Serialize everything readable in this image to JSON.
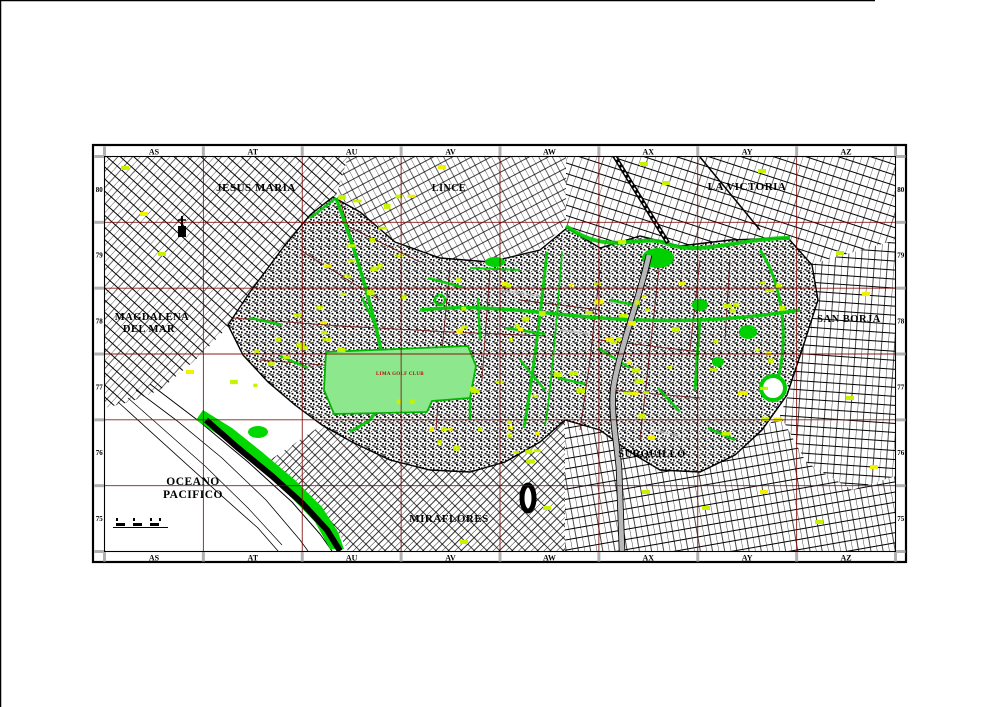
{
  "frame": {
    "columns": [
      "AS",
      "AT",
      "AU",
      "AV",
      "AW",
      "AX",
      "AY",
      "AZ"
    ],
    "rows": [
      "80",
      "79",
      "78",
      "77",
      "76",
      "75"
    ]
  },
  "labels": {
    "districts": [
      {
        "id": "jesus-maria",
        "text": "JESUS MARIA",
        "x": 256,
        "y": 191,
        "size": 11
      },
      {
        "id": "lince",
        "text": "LINCE",
        "x": 449,
        "y": 191,
        "size": 10
      },
      {
        "id": "la-victoria",
        "text": "LA VICTORIA",
        "x": 747,
        "y": 190,
        "size": 11
      },
      {
        "id": "magdalena-line1",
        "text": "MAGDALENA",
        "x": 152,
        "y": 320,
        "size": 10.5
      },
      {
        "id": "magdalena-line2",
        "text": "DEL MAR",
        "x": 149,
        "y": 332,
        "size": 10.5
      },
      {
        "id": "san-borja",
        "text": "SAN BORJA",
        "x": 849,
        "y": 322,
        "size": 10.5
      },
      {
        "id": "surquillo",
        "text": "SURQUILLO",
        "x": 652,
        "y": 457,
        "size": 10.5
      },
      {
        "id": "miraflores",
        "text": "MIRAFLORES",
        "x": 449,
        "y": 522,
        "size": 11
      },
      {
        "id": "oceano-line1",
        "text": "OCEANO",
        "x": 193,
        "y": 485,
        "size": 11.5
      },
      {
        "id": "oceano-line2",
        "text": "PACIFICO",
        "x": 193,
        "y": 498,
        "size": 11.5
      }
    ],
    "park": {
      "id": "lima-golf-club",
      "text": "LIMA GOLF CLUB",
      "x": 400,
      "y": 375,
      "size": 5,
      "color": "#c00000"
    }
  },
  "colors": {
    "frame": "#000000",
    "grid_line": "#7c0606",
    "tick": "#b0b0b0",
    "avenue_green": "#00cc00",
    "coast_green": "#00d800",
    "golf_green": "#8de88d",
    "golf_edge": "#00b400",
    "patch_green": "#c6f400",
    "patch_yellow": "#f0f000",
    "highway_gray": "#b8b8b8",
    "street_maroon": "#6d0b0b"
  }
}
